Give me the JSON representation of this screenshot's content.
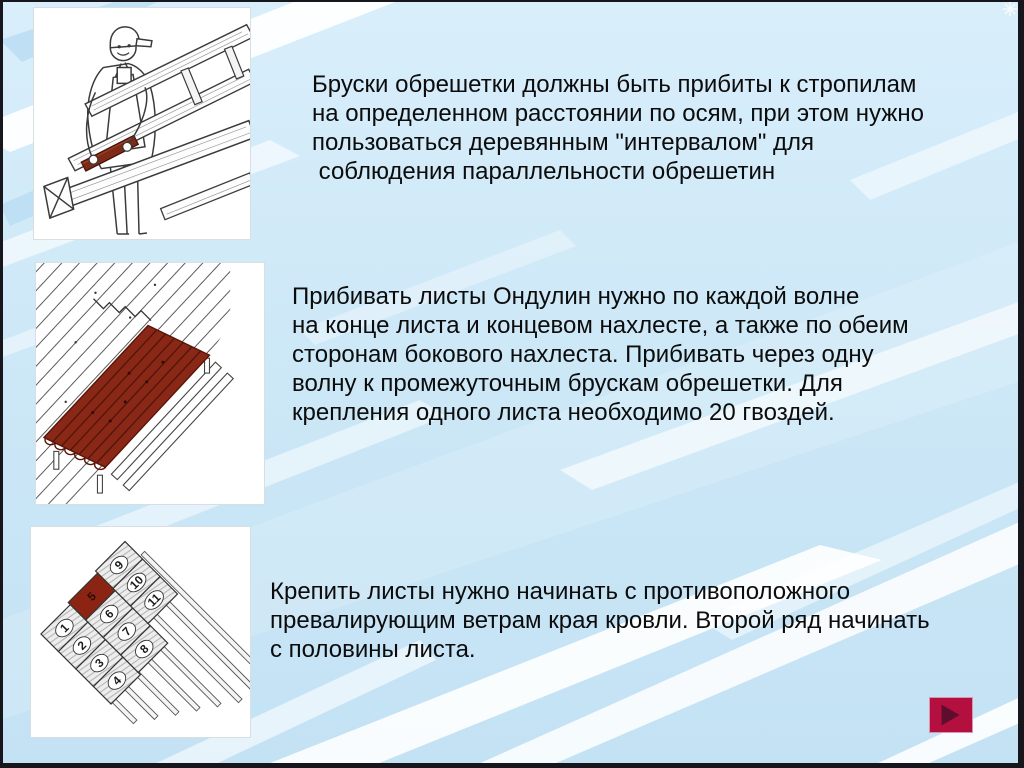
{
  "slide": {
    "background": {
      "base_color": "#cde8f7",
      "stripe_white": "#ffffff",
      "stripe_blue": "#abd6ef"
    },
    "paragraphs": [
      {
        "text": "Бруски обрешетки должны быть прибиты к стропилам\nна определенном расстоянии по осям, при этом нужно\nпользоваться деревянным \"интервалом\" для\n соблюдения параллельности обрешетин"
      },
      {
        "text": "Прибивать листы Ондулин нужно по каждой волне\nна конце листа и концевом нахлесте, а также по обеим\nсторонам бокового нахлеста. Прибивать через одну\nволну к промежуточным брускам обрешетки. Для\nкрепления одного листа необходимо 20 гвоздей."
      },
      {
        "text": "Крепить листы нужно начинать с противоположного\nпревалирующим ветрам края кровли. Второй ряд начинать\nс половины листа."
      }
    ]
  },
  "illustrations": {
    "worker": {
      "name": "worker-placing-interval-board",
      "interval_color": "#7e2a16"
    },
    "ondulin_sheet": {
      "name": "ondulin-sheet-on-battens",
      "sheet_color": "#8a2817"
    },
    "layout": {
      "name": "sheet-fixing-order-diagram",
      "sheet_numbers": [
        "1",
        "2",
        "3",
        "4",
        "5",
        "6",
        "7",
        "8",
        "9",
        "10",
        "11"
      ],
      "highlighted_sheet": "5",
      "highlight_color": "#8b2412"
    }
  },
  "nav": {
    "next_button": {
      "fill": "#b30f3f",
      "arrow": "#5c0e2c"
    }
  }
}
